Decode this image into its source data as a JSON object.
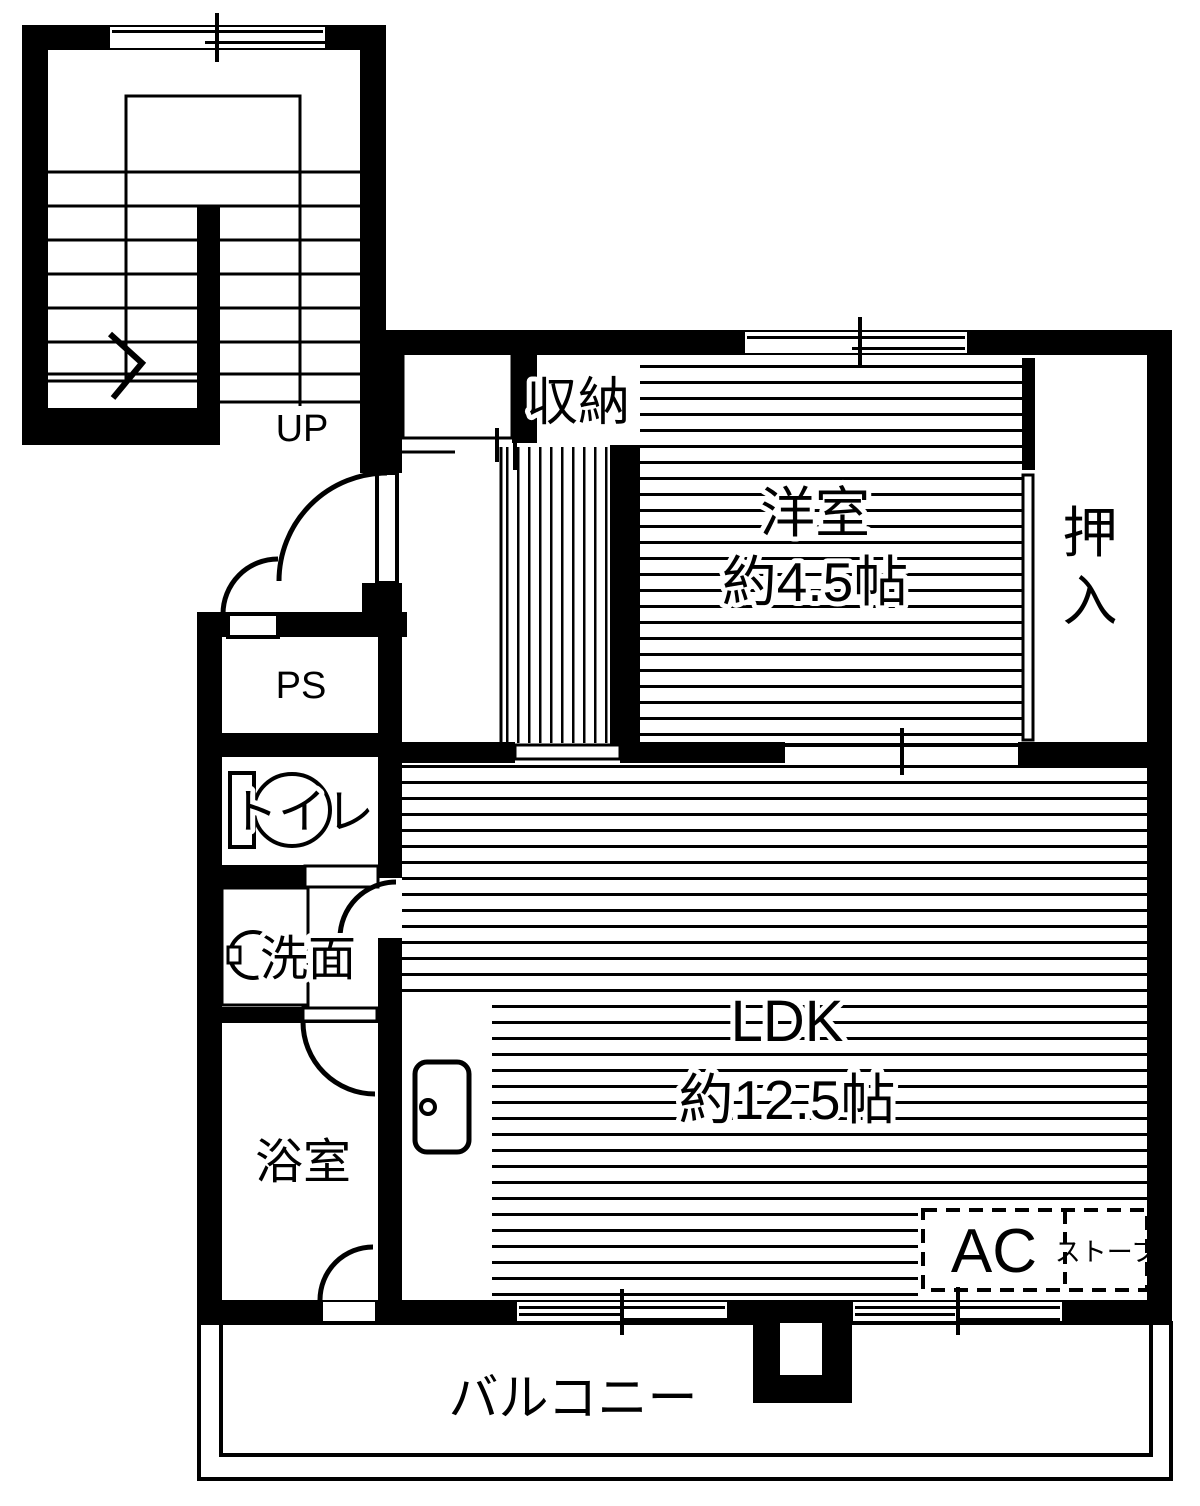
{
  "plan": {
    "stairwell": {
      "up_label": "UP"
    },
    "storage": {
      "label": "収納"
    },
    "western_room": {
      "label": "洋室",
      "size": "約4.5帖"
    },
    "oshiire": {
      "char1": "押",
      "char2": "入"
    },
    "pipe_space": {
      "label": "PS"
    },
    "toilet": {
      "label": "トイレ"
    },
    "washroom": {
      "label": "洗面"
    },
    "bathroom": {
      "label": "浴室"
    },
    "ldk": {
      "label": "LDK",
      "size": "約12.5帖"
    },
    "ac_unit": {
      "label": "AC"
    },
    "stove": {
      "label": "ストーブ"
    },
    "balcony": {
      "label": "バルコニー"
    },
    "colors": {
      "ink": "#000000",
      "background": "#ffffff"
    }
  }
}
